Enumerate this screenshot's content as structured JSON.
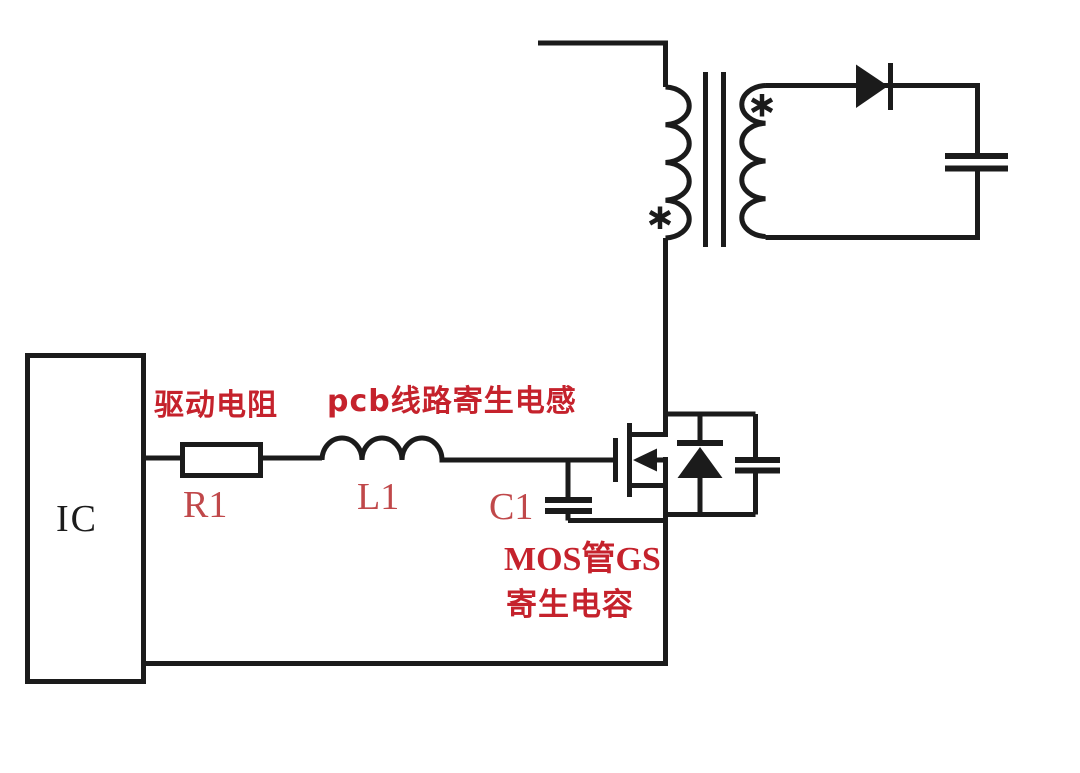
{
  "diagram": {
    "type": "circuit-schematic",
    "subject": "MOSFET gate drive parasitics in a flyback converter",
    "colors": {
      "line_black": "#1b1b1b",
      "annotation_red": "#c5222c",
      "reference_red": "#c0484a",
      "background": "#ffffff"
    },
    "ic": {
      "label": "IC"
    },
    "annotations": {
      "drive_resistor": "驱动电阻",
      "pcb_parasitic_inductance": "pcb线路寄生电感",
      "mos_gs_line1": "MOS管GS",
      "mos_gs_line2": "寄生电容"
    },
    "references": {
      "resistor": "R1",
      "inductor": "L1",
      "capacitor": "C1"
    },
    "polarity_marks": {
      "primary": "*",
      "secondary": "*"
    },
    "components": [
      "IC driver block",
      "drive resistor R1",
      "pcb trace parasitic inductor L1",
      "MOSFET gate-source parasitic capacitor C1",
      "N-channel MOSFET",
      "body diode with parallel snubber capacitor",
      "transformer (primary and secondary windings with polarity marks)",
      "output rectifier diode",
      "output capacitor"
    ]
  }
}
